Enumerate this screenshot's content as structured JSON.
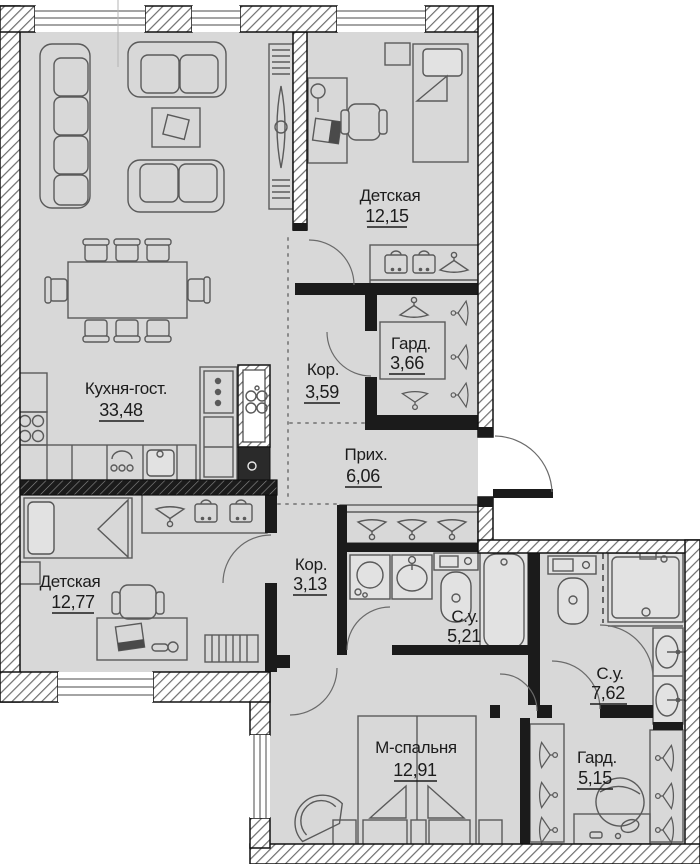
{
  "plan": {
    "type": "apartment-floor-plan",
    "colors": {
      "floor": "#d8d8d8",
      "wall_dark": "#1b1b1b",
      "wall_hatch_line": "#6e6e6e",
      "background": "#ffffff",
      "text": "#1c1c1c"
    },
    "rooms": [
      {
        "id": "kitchen-living",
        "name": "Кухня-гост.",
        "area": "33,48"
      },
      {
        "id": "children-room-1",
        "name": "Детская",
        "area": "12,15"
      },
      {
        "id": "wardrobe-1",
        "name": "Гард.",
        "area": "3,66"
      },
      {
        "id": "corridor-1",
        "name": "Кор.",
        "area": "3,59"
      },
      {
        "id": "hallway",
        "name": "Прих.",
        "area": "6,06"
      },
      {
        "id": "corridor-2",
        "name": "Кор.",
        "area": "3,13"
      },
      {
        "id": "bathroom-1",
        "name": "С.у.",
        "area": "5,21"
      },
      {
        "id": "children-room-2",
        "name": "Детская",
        "area": "12,77"
      },
      {
        "id": "bathroom-2",
        "name": "С.у.",
        "area": "7,62"
      },
      {
        "id": "master-bedroom",
        "name": "М-спальня",
        "area": "12,91"
      },
      {
        "id": "wardrobe-2",
        "name": "Гард.",
        "area": "5,15"
      }
    ]
  }
}
